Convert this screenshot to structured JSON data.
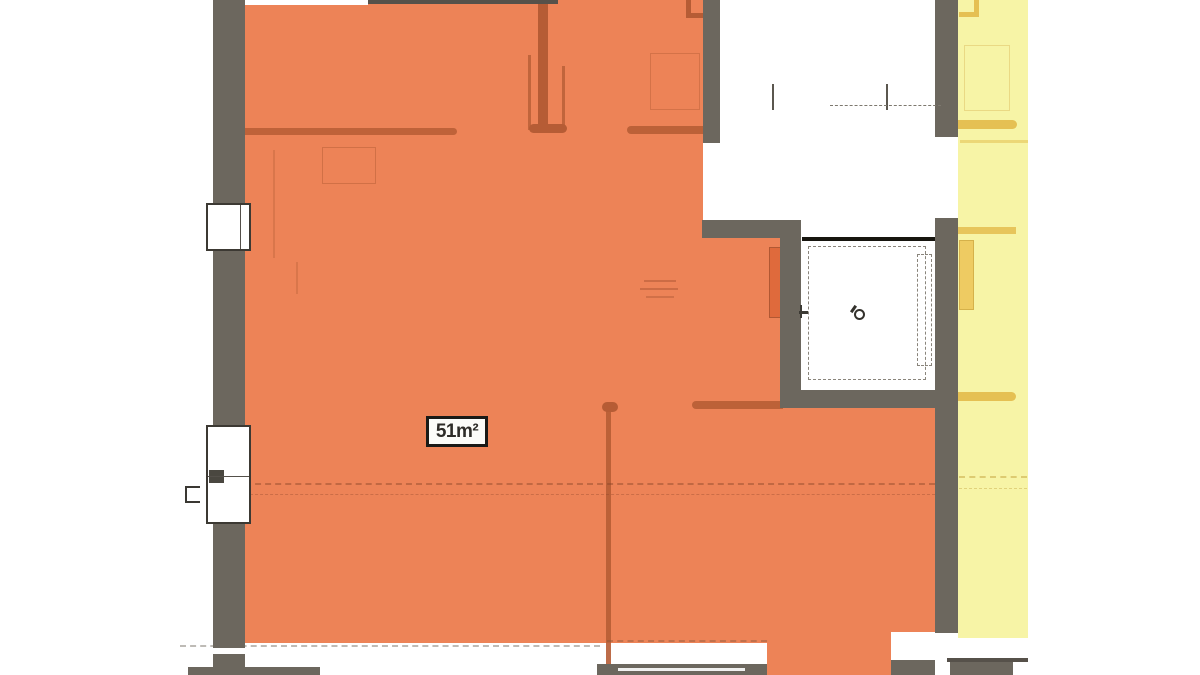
{
  "floor_plan": {
    "unit_area_label": "51m²"
  },
  "theme": {
    "bg": "#ffffff",
    "wall": "#6c675e",
    "wall-dark": "#56514a",
    "unit": "#f08255",
    "unit-line": "#b85c33",
    "adjacent": "#f7f4a4",
    "adjacent-line": "#e6c050",
    "ink": "#1b1a17"
  }
}
